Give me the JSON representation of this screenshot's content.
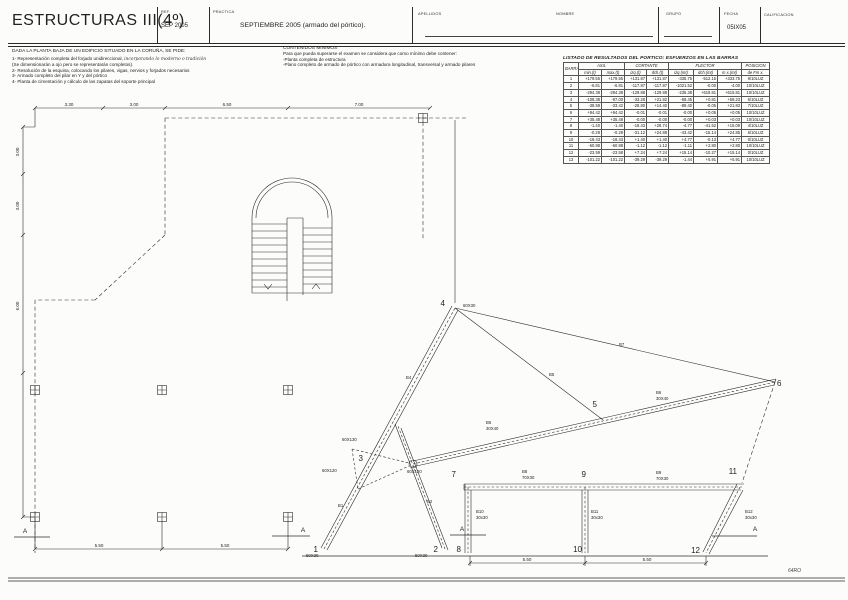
{
  "header": {
    "title": "ESTRUCTURAS III(4º)",
    "ref_label": "REF.",
    "ref_value": "SEP 2005",
    "practica_label": "PRACTICA",
    "practica_value": "SEPTIEMBRE 2005 (armado del pórtico).",
    "apellidos_label": "APELLIDOS",
    "nombre_label": "NOMBRE",
    "grupo_label": "GRUPO",
    "fecha_label": "FECHA",
    "fecha_value": "05IX05",
    "calificacion_label": "CALIFICACION"
  },
  "brief": {
    "intro": "DADA LA PLANTA BAJA DE UN EDIFICIO SITUADO EN LA CORUÑA, SE PIDE:",
    "item1": "1- Representación completa del forjado unidireccional,",
    "item1_handwritten": "incorporando lo moderno o tradición",
    "item1b": "(Se dimensionarán a ojo pero se representarán completos).",
    "item2": "2- Resolución de la esquina, colocando los pilares, vigas, nervios y forjados necesarios",
    "item3": "3- Armado completo del pilar en Y y del pórtico",
    "item4": "4- Planta de cimentación y cálculo de las zapatas del soporte principal"
  },
  "contenidos": {
    "title": "CONTENIDOS MINIMOS",
    "line1": "Para que pueda superarse el examen se considera que como mínimo debe contener:",
    "line2": "-Planta completa de estructura",
    "line3": "-Plano completo de armado de pórtico con armadura longitudinal, transversal y armado pilares"
  },
  "table": {
    "title": "LISTADO DE RESULTADOS DEL PORTICO: ESFUERZOS EN LAS BARRAS",
    "groups": [
      "BARRA",
      "AXIL",
      "CORTANTE",
      "FLECTOR",
      "POSICION"
    ],
    "subheaders": [
      "min.(t)",
      "max.(t)",
      "izq.(t)",
      "dch.(t)",
      "izq.(mt)",
      "dch.(mt)",
      "m x.(mt)",
      "de Fm x."
    ],
    "rows": [
      [
        "1",
        "+179.55",
        "+179.55",
        "+131.87",
        "+131.87",
        "-335.75",
        "-512.15",
        "+333.75",
        "9/10LUZ"
      ],
      [
        "2",
        "-6.81",
        "-6.81",
        "-117.87",
        "-117.87",
        "-1021.52",
        "-0.00",
        "-4.00",
        "10/10LUZ"
      ],
      [
        "3",
        "-294.38",
        "-294.38",
        "-129.88",
        "-129.88",
        "-235.38",
        "+619.81",
        "+615.81",
        "10/10LUZ"
      ],
      [
        "4",
        "-108.38",
        "-97.00",
        "-33.28",
        "+21.82",
        "-58.45",
        "+0.81",
        "+58.23",
        "6/10LUZ"
      ],
      [
        "5",
        "-38.59",
        "-33.42",
        "-28.80",
        "+14.40",
        "-89.40",
        "-0.05",
        "+21.83",
        "7/10LUZ"
      ],
      [
        "6",
        "+94.42",
        "+94.42",
        "-0.01",
        "-0.01",
        "-0.00",
        "+0.05",
        "+0.05",
        "10/10LUZ"
      ],
      [
        "7",
        "+35.48",
        "+35.48",
        "-0.00",
        "-0.00",
        "-0.00",
        "+0.03",
        "+0.03",
        "10/10LUZ"
      ],
      [
        "8",
        "-1.40",
        "-1.40",
        "-18.43",
        "+28.74",
        "-4.77",
        "-41.52",
        "+15.09",
        "4/10LUZ"
      ],
      [
        "9",
        "-0.29",
        "-0.29",
        "-31.12",
        "+24.88",
        "-43.42",
        "-15.14",
        "+24.85",
        "6/10LUZ"
      ],
      [
        "10",
        "-18.43",
        "-18.43",
        "+1.40",
        "+1.40",
        "+4.77",
        "-0.13",
        "+4.77",
        "0/10LUZ"
      ],
      [
        "11",
        "-60.88",
        "-60.88",
        "-1.12",
        "-1.12",
        "-1.11",
        "+2.80",
        "+2.80",
        "10/10LUZ"
      ],
      [
        "12",
        "-23.59",
        "-23.58",
        "+7.24",
        "+7.24",
        "+15.14",
        "-10.27",
        "+15.14",
        "0/10LUZ"
      ],
      [
        "13",
        "-101.22",
        "-101.22",
        "-39.29",
        "-39.29",
        "-1.44",
        "+5.91",
        "+5.91",
        "10/10LUZ"
      ]
    ]
  },
  "plan": {
    "dims_top": [
      "3.30",
      "3.00",
      "6.50",
      "7.00"
    ],
    "dims_left": [
      "3.00",
      "3.00",
      "6.00"
    ],
    "dims_bottom": [
      "5.50",
      "5.50"
    ]
  },
  "markers": {
    "a": "A"
  },
  "portico": {
    "nodes": [
      "1",
      "2",
      "3",
      "4",
      "5",
      "6",
      "7",
      "8",
      "9",
      "10",
      "11",
      "12"
    ],
    "bars": {
      "b1": "B1",
      "b2": "B2",
      "b4": "B4",
      "b5": "B5",
      "b7": "B7"
    },
    "b6a": [
      "B6",
      "30X40"
    ],
    "b6b": [
      "B6",
      "30X40"
    ],
    "b8": [
      "B8",
      "70X30"
    ],
    "b9": [
      "B9",
      "70X30"
    ],
    "b10": [
      "B10",
      "30x30"
    ],
    "b11": [
      "B11",
      "30x30"
    ],
    "b12": [
      "B12",
      "30x30"
    ],
    "sections": {
      "n4": "60X30",
      "s3a": "60X130",
      "s3b": "60X120",
      "s3c": "60X120",
      "base1": "50X30",
      "base2": "50X30"
    },
    "dims": [
      "5.50",
      "5.50"
    ]
  },
  "footer": {
    "stamp": "64RO"
  }
}
